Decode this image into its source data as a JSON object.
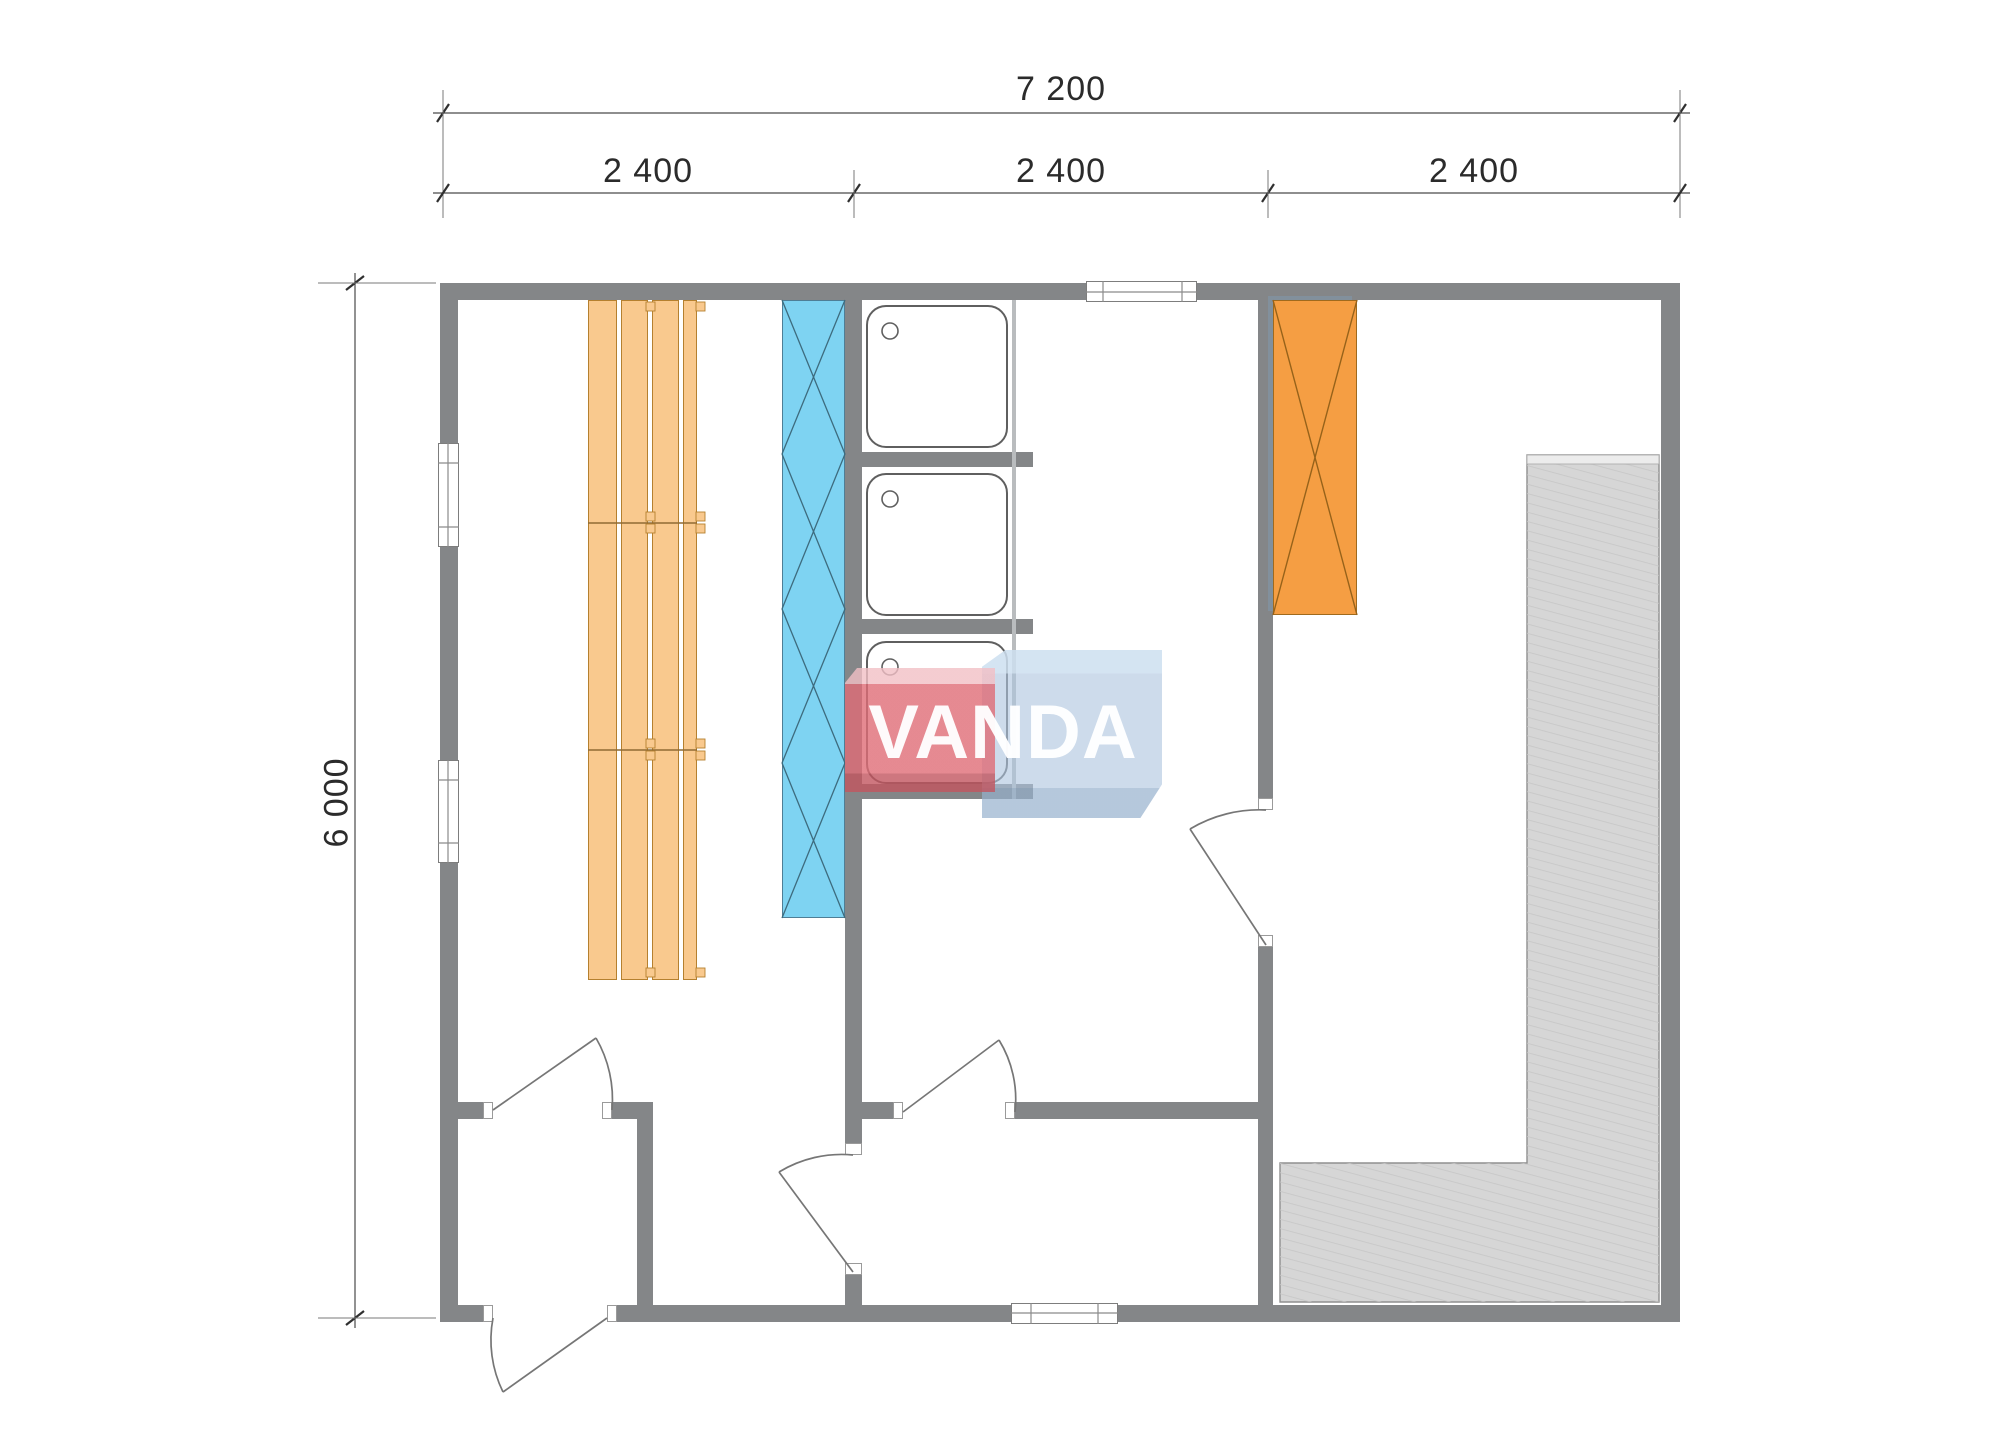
{
  "watermark": {
    "brand": "VANDA"
  },
  "dimensions": {
    "overall_width": "7 200",
    "width_segments": [
      "2 400",
      "2 400",
      "2 400"
    ],
    "overall_height": "6 000"
  },
  "colors": {
    "wall": "#848688",
    "bench_wood": "#f9c98e",
    "bench_outline": "#b5802f",
    "heater_blue": "#7ed3f2",
    "wardrobe_orange": "#f59e43",
    "deck_gray": "#d6d6d6",
    "logo_red": "#df6c76",
    "logo_blue": "#aec5de",
    "dimension_text": "#2b2b2b"
  },
  "furniture_icons": [
    "sauna-bench-boards",
    "sauna-heater",
    "shower-tray",
    "shower-tray",
    "shower-tray",
    "wardrobe-unit",
    "corner-deck-bench"
  ]
}
